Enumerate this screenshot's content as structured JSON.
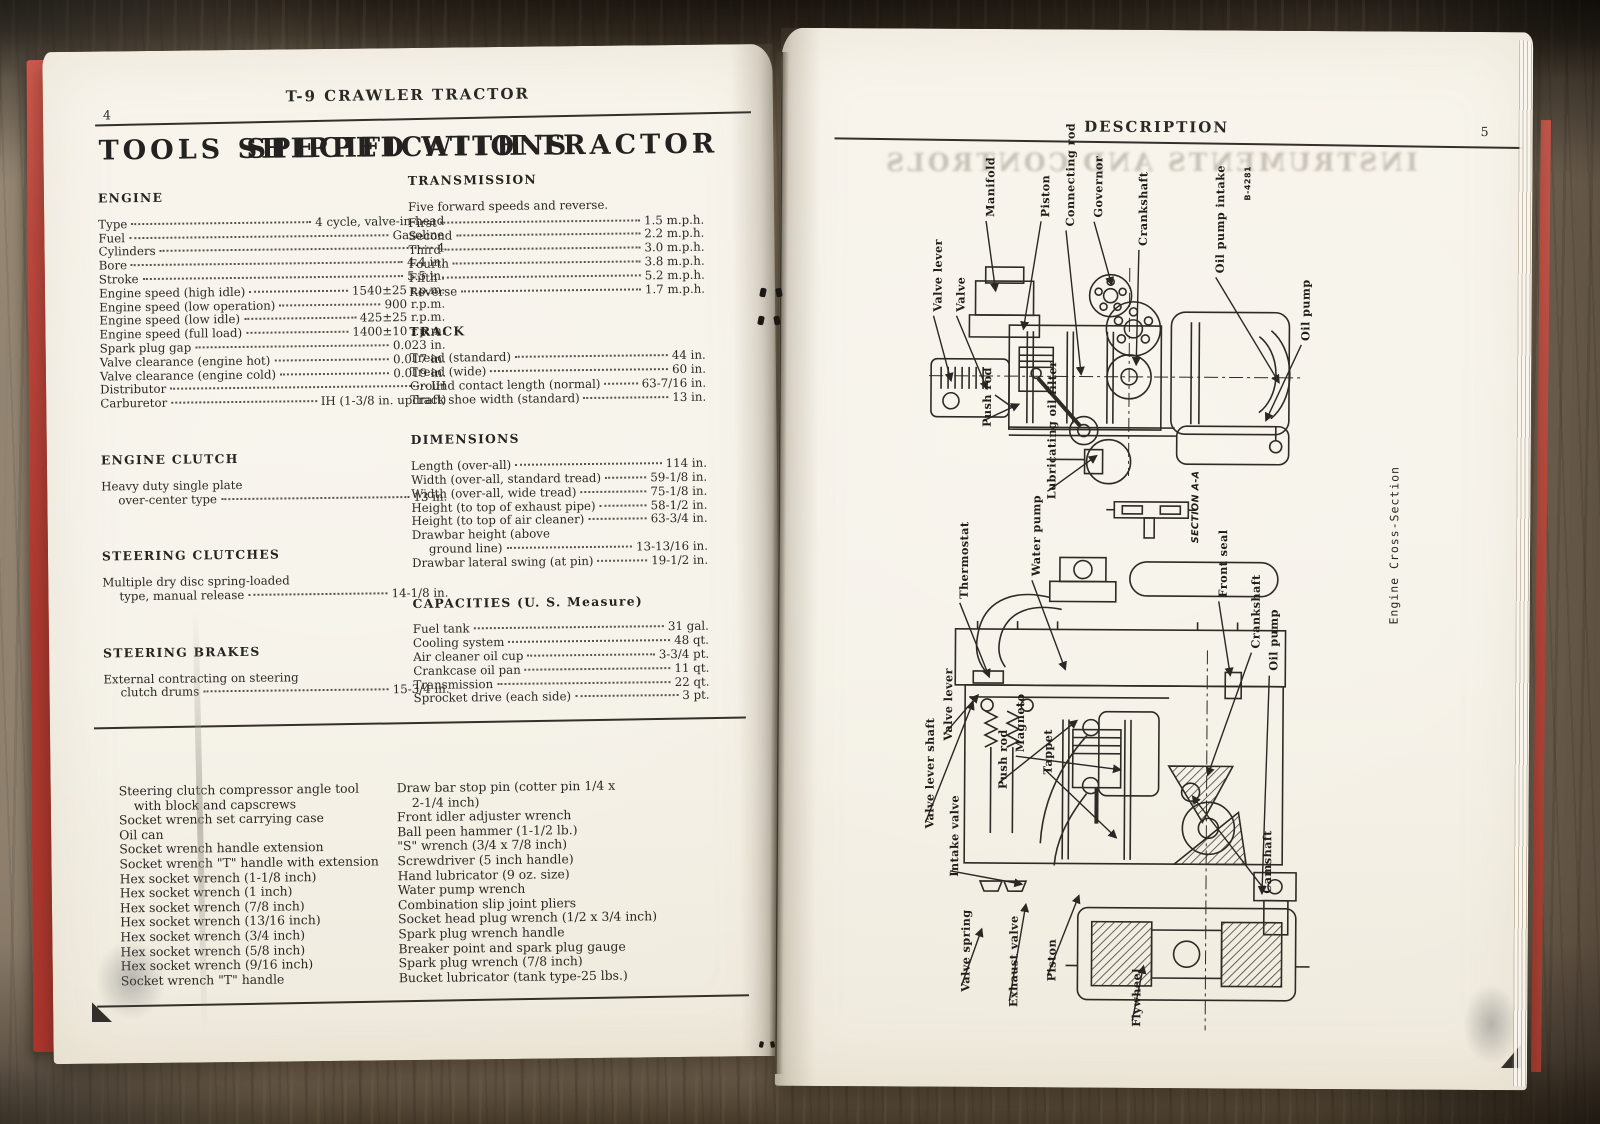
{
  "left_page": {
    "page_number": "4",
    "running_title": "T-9 CRAWLER TRACTOR",
    "title": "SPECIFICATIONS",
    "col_left": [
      {
        "heading": "ENGINE",
        "rows": [
          {
            "label": "Type",
            "value": "4 cycle, valve-in-head"
          },
          {
            "label": "Fuel",
            "value": "Gasoline"
          },
          {
            "label": "Cylinders",
            "value": "4"
          },
          {
            "label": "Bore",
            "value": "4.4 in."
          },
          {
            "label": "Stroke",
            "value": "5.5 in."
          },
          {
            "label": "Engine speed (high idle)",
            "value": "1540±25 r.p.m."
          },
          {
            "label": "Engine speed (low operation)",
            "value": "900 r.p.m."
          },
          {
            "label": "Engine speed (low idle)",
            "value": "425±25 r.p.m."
          },
          {
            "label": "Engine speed (full load)",
            "value": "1400±10 r.p.m."
          },
          {
            "label": "Spark plug gap",
            "value": "0.023 in."
          },
          {
            "label": "Valve clearance (engine hot)",
            "value": "0.017 in."
          },
          {
            "label": "Valve clearance (engine cold)",
            "value": "0.019 in."
          },
          {
            "label": "Distributor",
            "value": "IH"
          },
          {
            "label": "Carburetor",
            "value": "IH (1-3/8 in. updraft)"
          }
        ]
      },
      {
        "heading": "ENGINE CLUTCH",
        "rows": [
          {
            "pre": "Heavy duty single plate",
            "label": "over-center type",
            "value": "13 in.",
            "indent": true
          }
        ]
      },
      {
        "heading": "STEERING CLUTCHES",
        "rows": [
          {
            "pre": "Multiple dry disc spring-loaded",
            "label": "type, manual release",
            "value": "14-1/8 in.",
            "indent": true
          }
        ]
      },
      {
        "heading": "STEERING BRAKES",
        "rows": [
          {
            "pre": "External contracting on steering",
            "label": "clutch drums",
            "value": "15-3/4 in.",
            "indent": true
          }
        ]
      }
    ],
    "col_right": [
      {
        "heading": "TRANSMISSION",
        "intro": "Five forward speeds and reverse.",
        "rows": [
          {
            "label": "First",
            "value": "1.5 m.p.h."
          },
          {
            "label": "Second",
            "value": "2.2 m.p.h."
          },
          {
            "label": "Third",
            "value": "3.0 m.p.h."
          },
          {
            "label": "Fourth",
            "value": "3.8 m.p.h."
          },
          {
            "label": "Fifth",
            "value": "5.2 m.p.h."
          },
          {
            "label": "Reverse",
            "value": "1.7 m.p.h."
          }
        ]
      },
      {
        "heading": "TRACK",
        "rows": [
          {
            "label": "Tread (standard)",
            "value": "44 in."
          },
          {
            "label": "Tread (wide)",
            "value": "60 in."
          },
          {
            "label": "Ground contact length (normal)",
            "value": "63-7/16 in."
          },
          {
            "label": "Track shoe width (standard)",
            "value": "13 in."
          }
        ]
      },
      {
        "heading": "DIMENSIONS",
        "rows": [
          {
            "label": "Length (over-all)",
            "value": "114 in."
          },
          {
            "label": "Width (over-all, standard tread)",
            "value": "59-1/8 in."
          },
          {
            "label": "Width (over-all, wide tread)",
            "value": "75-1/8 in."
          },
          {
            "label": "Height (to top of exhaust pipe)",
            "value": "58-1/2 in."
          },
          {
            "label": "Height (to top of air cleaner)",
            "value": "63-3/4 in."
          },
          {
            "pre": "Drawbar height (above",
            "label": "ground line)",
            "value": "13-13/16 in.",
            "indent": true
          },
          {
            "label": "Drawbar lateral swing (at pin)",
            "value": "19-1/2 in."
          }
        ]
      },
      {
        "heading": "CAPACITIES (U. S. Measure)",
        "rows": [
          {
            "label": "Fuel tank",
            "value": "31 gal."
          },
          {
            "label": "Cooling system",
            "value": "48 qt."
          },
          {
            "label": "Air cleaner oil cup",
            "value": "3-3/4 pt."
          },
          {
            "label": "Crankcase oil pan",
            "value": "11 qt."
          },
          {
            "label": "Transmission",
            "value": "22 qt."
          },
          {
            "label": "Sprocket drive (each side)",
            "value": "3 pt."
          }
        ]
      }
    ],
    "tools": {
      "title": "TOOLS SHIPPED WITH TRACTOR",
      "col_left": [
        {
          "text": "Steering clutch compressor angle tool",
          "cont": "with block and capscrews"
        },
        {
          "text": "Socket wrench set carrying case"
        },
        {
          "text": "Oil can"
        },
        {
          "text": "Socket wrench handle extension"
        },
        {
          "text": "Socket wrench \"T\" handle with extension"
        },
        {
          "text": "Hex socket wrench (1-1/8 inch)"
        },
        {
          "text": "Hex socket wrench (1 inch)"
        },
        {
          "text": "Hex socket wrench (7/8 inch)"
        },
        {
          "text": "Hex socket wrench (13/16 inch)"
        },
        {
          "text": "Hex socket wrench (3/4 inch)"
        },
        {
          "text": "Hex socket wrench (5/8 inch)"
        },
        {
          "text": "Hex socket wrench (9/16 inch)"
        },
        {
          "text": "Socket wrench \"T\" handle"
        }
      ],
      "col_right": [
        {
          "text": "Draw bar stop pin (cotter pin 1/4 x",
          "cont": "2-1/4 inch)"
        },
        {
          "text": "Front idler adjuster wrench"
        },
        {
          "text": "Ball peen hammer (1-1/2 lb.)"
        },
        {
          "text": "\"S\" wrench (3/4 x 7/8 inch)"
        },
        {
          "text": "Screwdriver (5 inch handle)"
        },
        {
          "text": "Hand lubricator (9 oz. size)"
        },
        {
          "text": "Water pump wrench"
        },
        {
          "text": "Combination slip joint pliers"
        },
        {
          "text": "Socket head plug wrench (1/2 x 3/4 inch)"
        },
        {
          "text": "Spark plug wrench handle"
        },
        {
          "text": "Breaker point and spark plug gauge"
        },
        {
          "text": "Spark plug wrench (7/8 inch)"
        },
        {
          "text": "Bucket lubricator (tank type-25 lbs.)"
        }
      ]
    }
  },
  "right_page": {
    "page_number": "5",
    "running_title": "DESCRIPTION",
    "ghost_title": "INSTRUMENTS AND CONTROLS",
    "figure_number": "B-4281",
    "top_labels": [
      {
        "id": "manifold",
        "text": "Manifold"
      },
      {
        "id": "piston",
        "text": "Piston"
      },
      {
        "id": "connecting-rod",
        "text": "Connecting rod"
      },
      {
        "id": "governor",
        "text": "Governor"
      },
      {
        "id": "crankshaft-top",
        "text": "Crankshaft"
      },
      {
        "id": "oil-pump-intake",
        "text": "Oil pump intake"
      },
      {
        "id": "fig-number",
        "text": "B-4281"
      },
      {
        "id": "valve-lever-top",
        "text": "Valve lever"
      },
      {
        "id": "valve-top",
        "text": "Valve"
      },
      {
        "id": "push-rod-top",
        "text": "Push rod"
      },
      {
        "id": "lubricating-oil-filter",
        "text": "Lubricating oil filter"
      },
      {
        "id": "oil-pump-top",
        "text": "Oil pump"
      },
      {
        "id": "section-aa",
        "text": "SECTION A-A"
      }
    ],
    "bottom_labels": [
      {
        "id": "thermostat",
        "text": "Thermostat"
      },
      {
        "id": "water-pump",
        "text": "Water pump"
      },
      {
        "id": "front-seal",
        "text": "Front seal"
      },
      {
        "id": "crankshaft-bottom",
        "text": "Crankshaft"
      },
      {
        "id": "oil-pump-bottom",
        "text": "Oil pump"
      },
      {
        "id": "valve-lever-bottom",
        "text": "Valve lever"
      },
      {
        "id": "valve-lever-shaft",
        "text": "Valve lever shaft"
      },
      {
        "id": "magneto",
        "text": "Magneto"
      },
      {
        "id": "push-rod-bottom",
        "text": "Push rod"
      },
      {
        "id": "tappet",
        "text": "Tappet"
      },
      {
        "id": "intake-valve",
        "text": "Intake valve"
      },
      {
        "id": "valve-spring",
        "text": "Valve spring"
      },
      {
        "id": "exhaust-valve",
        "text": "Exhaust valve"
      },
      {
        "id": "piston-bottom",
        "text": "Piston"
      },
      {
        "id": "flywheel",
        "text": "Flywheel"
      },
      {
        "id": "camshaft",
        "text": "Camshaft"
      },
      {
        "id": "caption",
        "text": "Engine Cross-Section"
      }
    ]
  }
}
